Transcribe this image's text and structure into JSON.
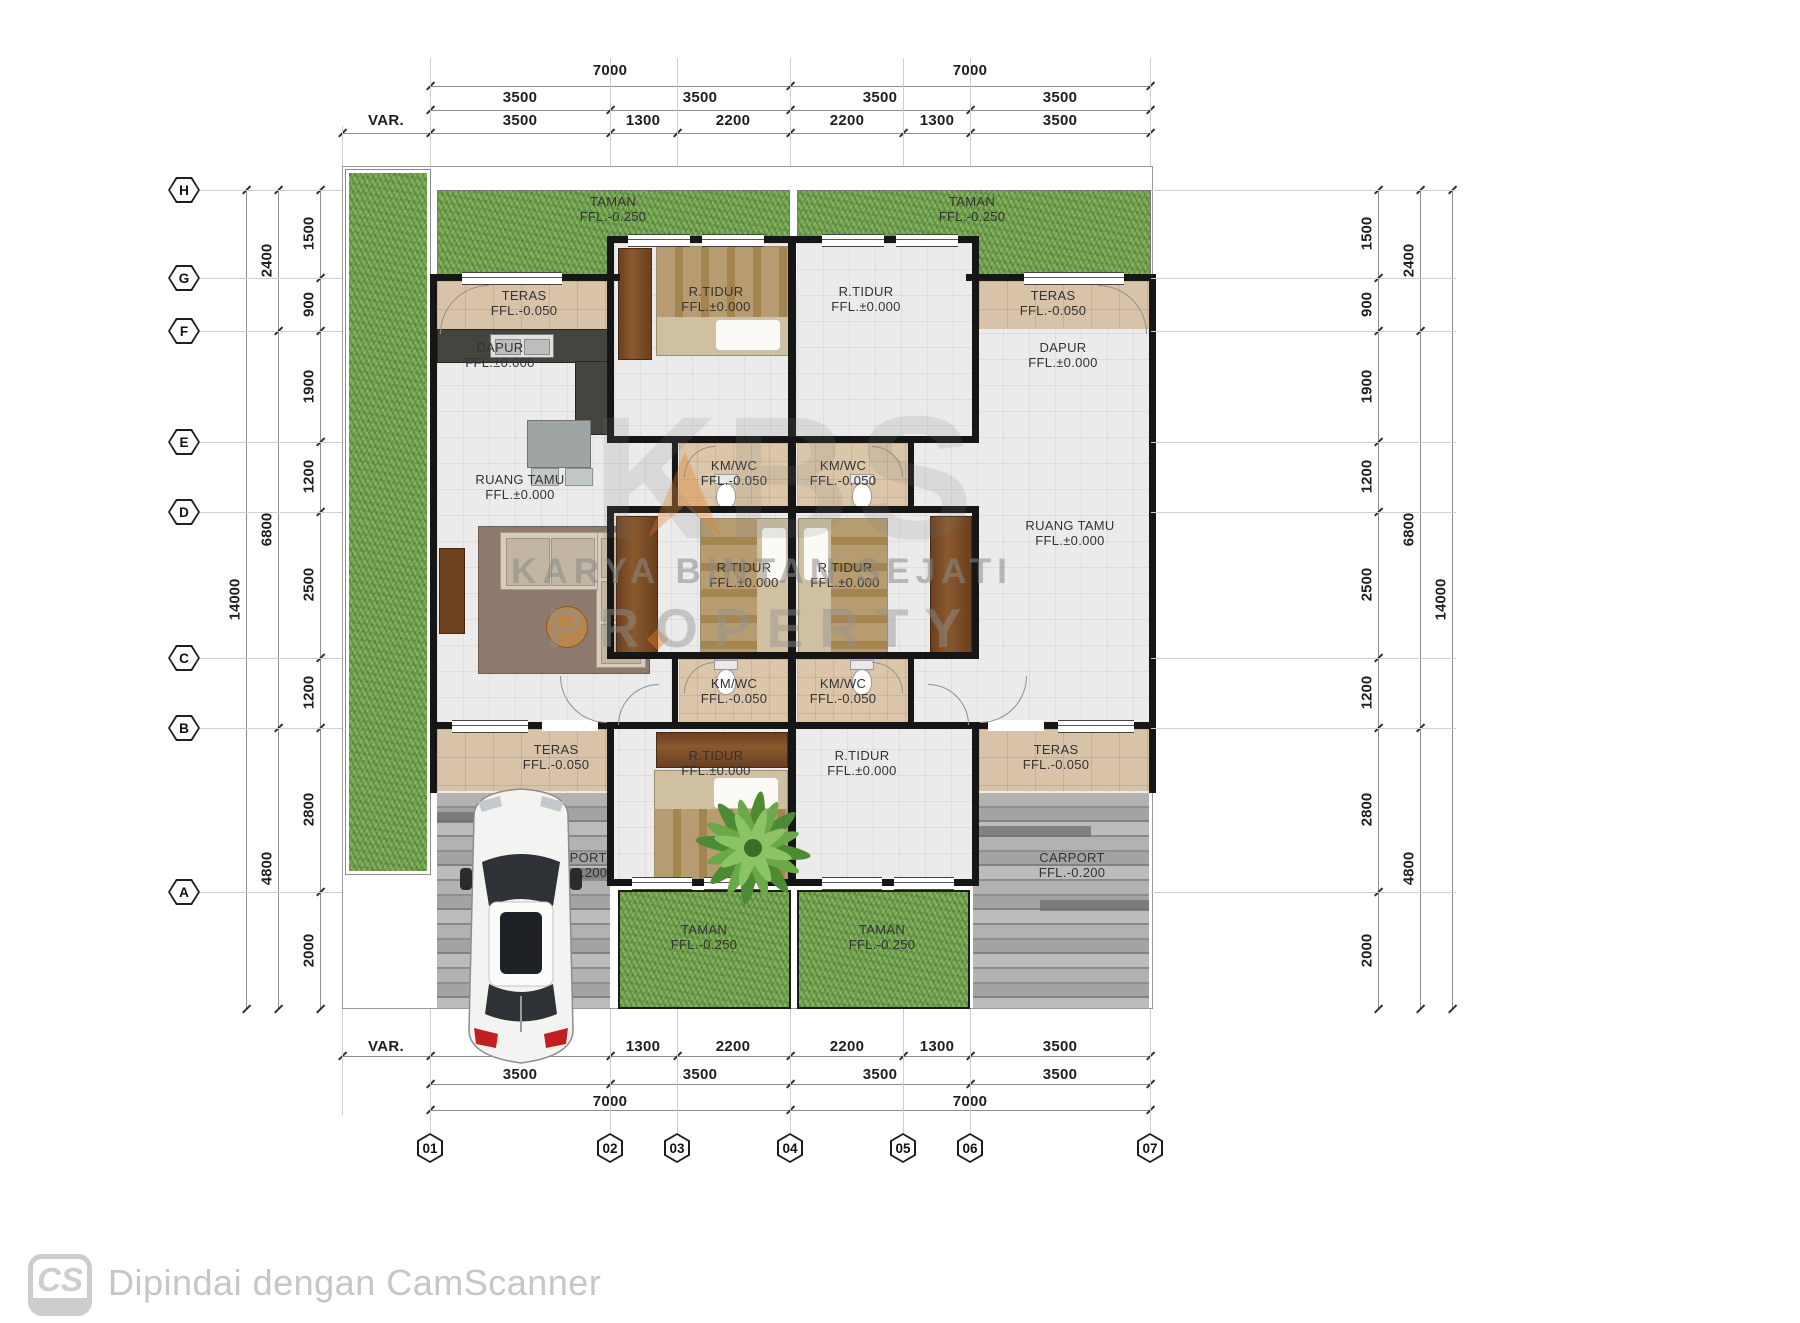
{
  "footer": {
    "logo_text": "CS",
    "scan_text": "Dipindai dengan CamScanner"
  },
  "watermark": {
    "big": "KBS",
    "line1": "KARYA BINTAN SEJATI",
    "line2": "PROPERTY"
  },
  "grid": {
    "row_labels": [
      {
        "t": "H",
        "y": 190
      },
      {
        "t": "G",
        "y": 278
      },
      {
        "t": "F",
        "y": 331
      },
      {
        "t": "E",
        "y": 442
      },
      {
        "t": "D",
        "y": 512
      },
      {
        "t": "C",
        "y": 658
      },
      {
        "t": "B",
        "y": 728
      },
      {
        "t": "A",
        "y": 892
      }
    ],
    "col_labels": [
      {
        "t": "01",
        "x": 430
      },
      {
        "t": "02",
        "x": 610
      },
      {
        "t": "03",
        "x": 677
      },
      {
        "t": "04",
        "x": 790
      },
      {
        "t": "05",
        "x": 903
      },
      {
        "t": "06",
        "x": 970
      },
      {
        "t": "07",
        "x": 1150
      }
    ]
  },
  "dims": {
    "top": [
      {
        "y": 62,
        "items": [
          {
            "t": "7000",
            "x": 610
          },
          {
            "t": "7000",
            "x": 970
          }
        ]
      },
      {
        "y": 89,
        "items": [
          {
            "t": "3500",
            "x": 520
          },
          {
            "t": "3500",
            "x": 700
          },
          {
            "t": "3500",
            "x": 880
          },
          {
            "t": "3500",
            "x": 1060
          }
        ]
      },
      {
        "y": 112,
        "items": [
          {
            "t": "VAR.",
            "x": 386
          },
          {
            "t": "3500",
            "x": 520
          },
          {
            "t": "1300",
            "x": 643
          },
          {
            "t": "2200",
            "x": 733
          },
          {
            "t": "2200",
            "x": 847
          },
          {
            "t": "1300",
            "x": 937
          },
          {
            "t": "3500",
            "x": 1060
          }
        ]
      }
    ],
    "bottom": [
      {
        "y": 1038,
        "items": [
          {
            "t": "VAR.",
            "x": 386
          },
          {
            "t": "3500",
            "x": 520
          },
          {
            "t": "1300",
            "x": 643
          },
          {
            "t": "2200",
            "x": 733
          },
          {
            "t": "2200",
            "x": 847
          },
          {
            "t": "1300",
            "x": 937
          },
          {
            "t": "3500",
            "x": 1060
          }
        ]
      },
      {
        "y": 1066,
        "items": [
          {
            "t": "3500",
            "x": 520
          },
          {
            "t": "3500",
            "x": 700
          },
          {
            "t": "3500",
            "x": 880
          },
          {
            "t": "3500",
            "x": 1060
          }
        ]
      },
      {
        "y": 1093,
        "items": [
          {
            "t": "7000",
            "x": 610
          },
          {
            "t": "7000",
            "x": 970
          }
        ]
      }
    ],
    "left": [
      {
        "x": 309,
        "items": [
          {
            "t": "1500",
            "y": 234
          },
          {
            "t": "900",
            "y": 305
          },
          {
            "t": "1900",
            "y": 387
          },
          {
            "t": "1200",
            "y": 477
          },
          {
            "t": "2500",
            "y": 585
          },
          {
            "t": "1200",
            "y": 693
          },
          {
            "t": "2800",
            "y": 810
          },
          {
            "t": "2000",
            "y": 951
          }
        ]
      },
      {
        "x": 267,
        "items": [
          {
            "t": "2400",
            "y": 261
          },
          {
            "t": "6800",
            "y": 530
          },
          {
            "t": "4800",
            "y": 869
          }
        ]
      },
      {
        "x": 235,
        "items": [
          {
            "t": "14000",
            "y": 600
          }
        ]
      }
    ],
    "right": [
      {
        "x": 1367,
        "items": [
          {
            "t": "1500",
            "y": 234
          },
          {
            "t": "900",
            "y": 305
          },
          {
            "t": "1900",
            "y": 387
          },
          {
            "t": "1200",
            "y": 477
          },
          {
            "t": "2500",
            "y": 585
          },
          {
            "t": "1200",
            "y": 693
          },
          {
            "t": "2800",
            "y": 810
          },
          {
            "t": "2000",
            "y": 951
          }
        ]
      },
      {
        "x": 1409,
        "items": [
          {
            "t": "2400",
            "y": 261
          },
          {
            "t": "6800",
            "y": 530
          },
          {
            "t": "4800",
            "y": 869
          }
        ]
      },
      {
        "x": 1441,
        "items": [
          {
            "t": "14000",
            "y": 600
          }
        ]
      }
    ]
  },
  "rooms": [
    {
      "name": "taman-top-left",
      "l1": "TAMAN",
      "l2": "FFL.-0.250",
      "x": 613,
      "y": 194
    },
    {
      "name": "taman-top-right",
      "l1": "TAMAN",
      "l2": "FFL.-0.250",
      "x": 972,
      "y": 194
    },
    {
      "name": "teras-top-left",
      "l1": "TERAS",
      "l2": "FFL.-0.050",
      "x": 524,
      "y": 288
    },
    {
      "name": "rtidur-top-left",
      "l1": "R.TIDUR",
      "l2": "FFL.±0.000",
      "x": 716,
      "y": 284
    },
    {
      "name": "rtidur-top-right",
      "l1": "R.TIDUR",
      "l2": "FFL.±0.000",
      "x": 866,
      "y": 284
    },
    {
      "name": "teras-top-right",
      "l1": "TERAS",
      "l2": "FFL.-0.050",
      "x": 1053,
      "y": 288
    },
    {
      "name": "dapur-left",
      "l1": "DAPUR",
      "l2": "FFL.±0.000",
      "x": 500,
      "y": 340
    },
    {
      "name": "dapur-right",
      "l1": "DAPUR",
      "l2": "FFL.±0.000",
      "x": 1063,
      "y": 340
    },
    {
      "name": "kmwc-upper-left",
      "l1": "KM/WC",
      "l2": "FFL.-0.050",
      "x": 734,
      "y": 458
    },
    {
      "name": "kmwc-upper-right",
      "l1": "KM/WC",
      "l2": "FFL.-0.050",
      "x": 843,
      "y": 458
    },
    {
      "name": "ruang-tamu-left",
      "l1": "RUANG TAMU",
      "l2": "FFL.±0.000",
      "x": 520,
      "y": 472
    },
    {
      "name": "ruang-tamu-right",
      "l1": "RUANG TAMU",
      "l2": "FFL.±0.000",
      "x": 1070,
      "y": 518
    },
    {
      "name": "rtidur-mid-left",
      "l1": "R.TIDUR",
      "l2": "FFL.±0.000",
      "x": 744,
      "y": 560
    },
    {
      "name": "rtidur-mid-right",
      "l1": "R.TIDUR",
      "l2": "FFL.±0.000",
      "x": 845,
      "y": 560
    },
    {
      "name": "kmwc-lower-left",
      "l1": "KM/WC",
      "l2": "FFL.-0.050",
      "x": 734,
      "y": 676
    },
    {
      "name": "kmwc-lower-right",
      "l1": "KM/WC",
      "l2": "FFL.-0.050",
      "x": 843,
      "y": 676
    },
    {
      "name": "teras-bottom-left",
      "l1": "TERAS",
      "l2": "FFL.-0.050",
      "x": 556,
      "y": 742
    },
    {
      "name": "teras-bottom-right",
      "l1": "TERAS",
      "l2": "FFL.-0.050",
      "x": 1056,
      "y": 742
    },
    {
      "name": "rtidur-bottom-left",
      "l1": "R.TIDUR",
      "l2": "FFL.±0.000",
      "x": 716,
      "y": 748
    },
    {
      "name": "rtidur-bottom-right",
      "l1": "R.TIDUR",
      "l2": "FFL.±0.000",
      "x": 862,
      "y": 748
    },
    {
      "name": "carport-left",
      "l1": "CARPORT",
      "l2": "FFL.-0.200",
      "x": 574,
      "y": 850
    },
    {
      "name": "carport-right",
      "l1": "CARPORT",
      "l2": "FFL.-0.200",
      "x": 1072,
      "y": 850
    },
    {
      "name": "taman-bottom-left",
      "l1": "TAMAN",
      "l2": "FFL.-0.250",
      "x": 704,
      "y": 922
    },
    {
      "name": "taman-bottom-right",
      "l1": "TAMAN",
      "l2": "FFL.-0.250",
      "x": 882,
      "y": 922
    }
  ],
  "colors": {
    "grass": "#7aa953",
    "teras": "#d8c2a8",
    "wall": "#161616",
    "accent_orange": "#e27e26",
    "taillight": "#c02020"
  }
}
